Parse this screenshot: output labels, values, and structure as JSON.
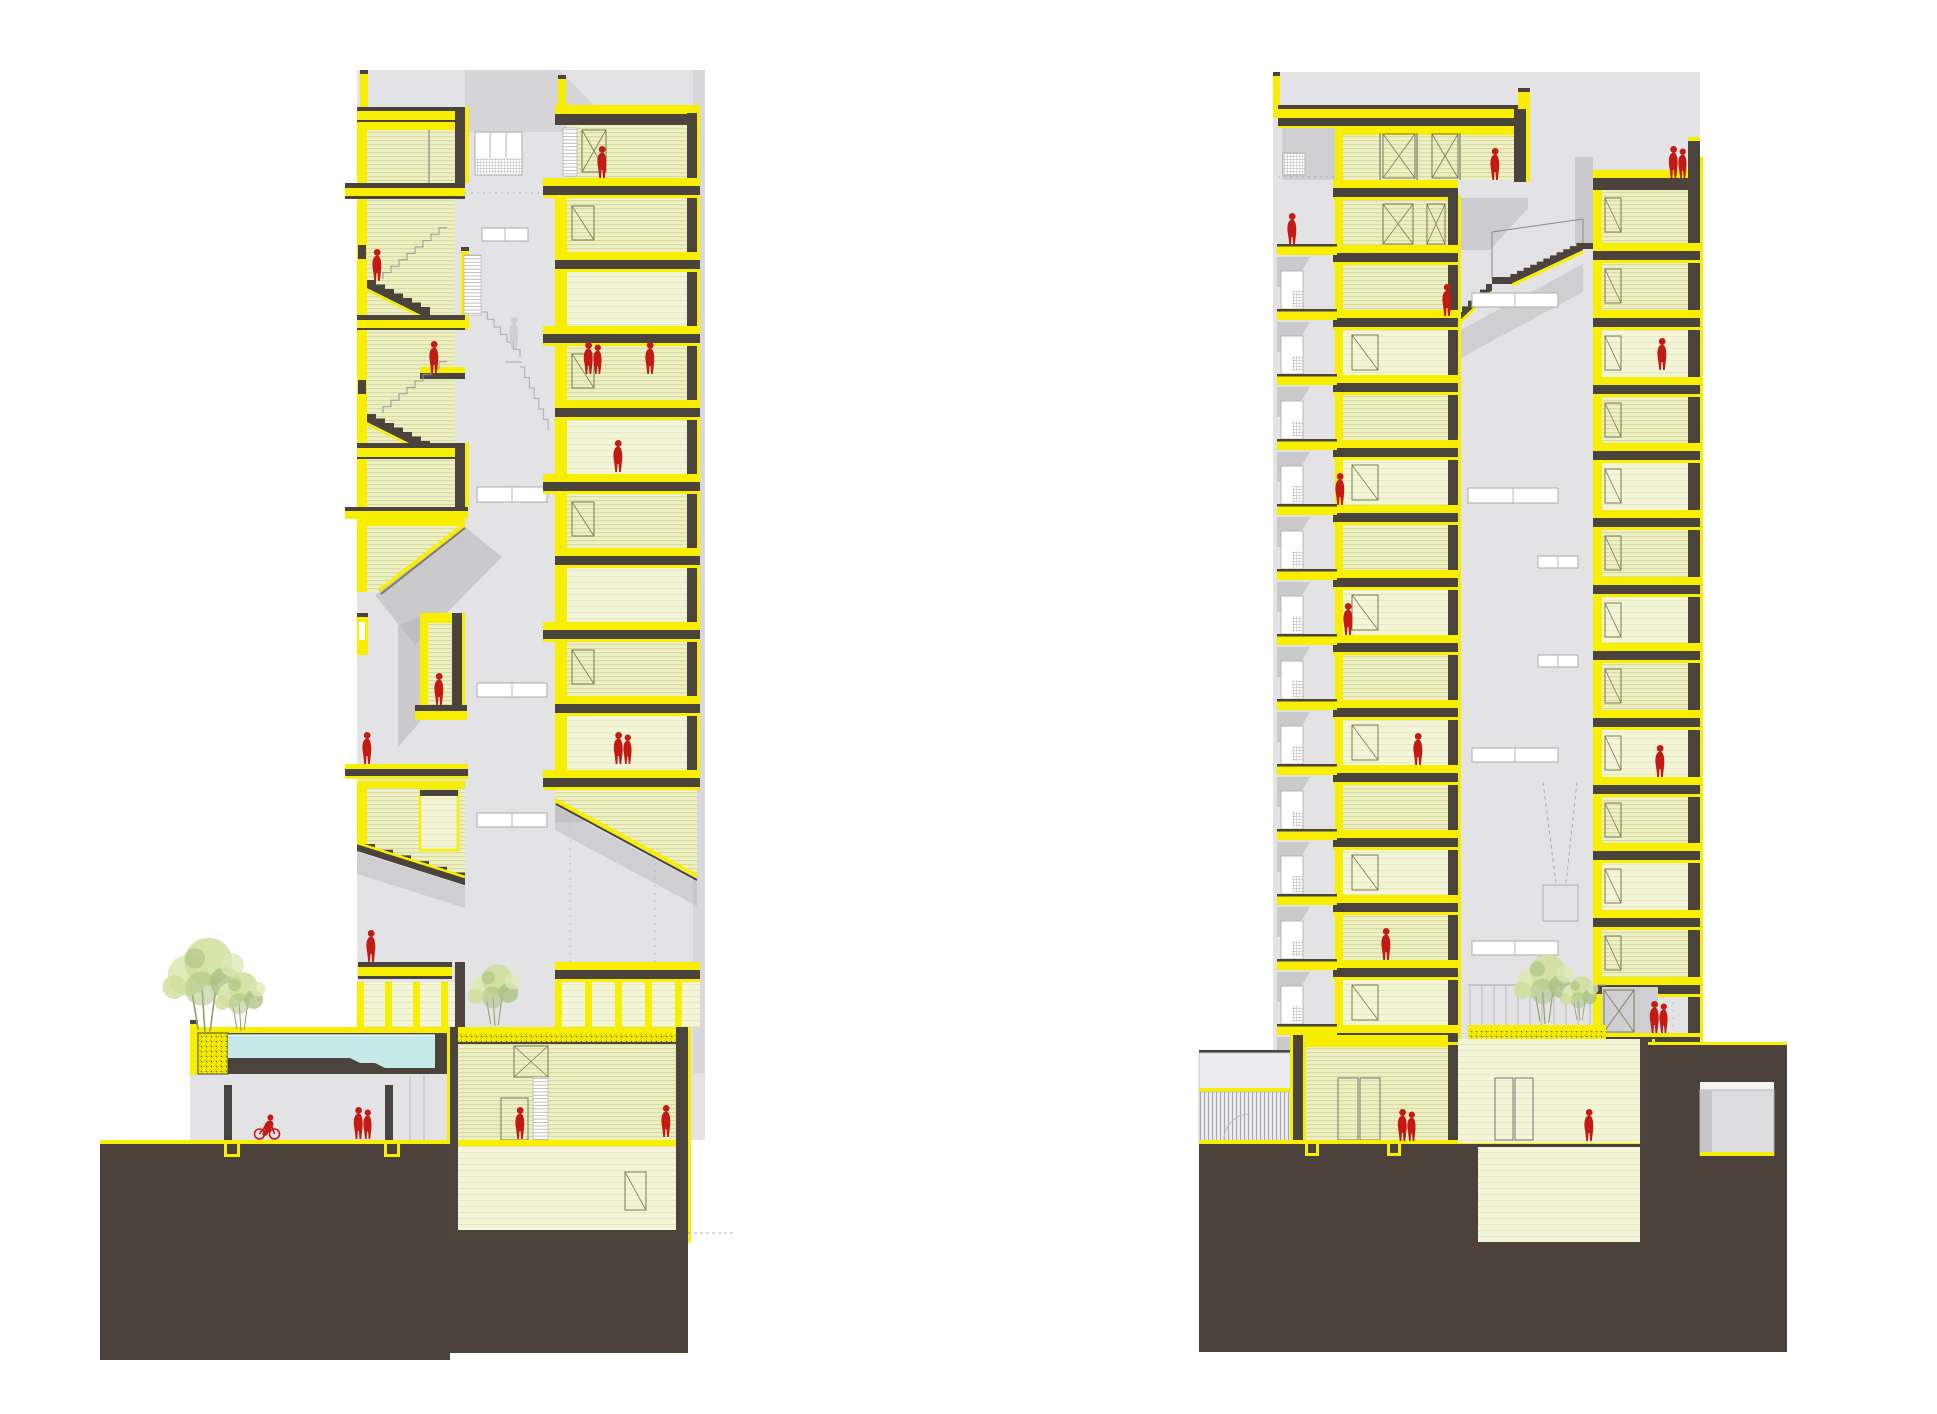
{
  "page": {
    "kind": "architectural-section-drawing",
    "sections": [
      {
        "id": "left-section",
        "label": "longitudinal section A"
      },
      {
        "id": "right-section",
        "label": "longitudinal section B"
      }
    ]
  },
  "colors": {
    "paper": "#ffffff",
    "backdrop": "#e3e3e5",
    "backdrop_dark": "#cfcfd1",
    "shadow": "#b2b2b4",
    "dark": "#4a443c",
    "ground": "#4a423b",
    "yellow": "#f7ee00",
    "room": "#edefc4",
    "roomline": "#d6d99a",
    "room_light": "#f3f5d8",
    "pool": "#c6eae9",
    "red": "#c31a13",
    "ghost": "#cfcfd1",
    "line": "#9a9a9c",
    "win": "#b7b7b9",
    "doorline": "#7a7a55",
    "green1": "#cfdf9a",
    "green2": "#a6c07f",
    "green3": "#dde9b4"
  },
  "left_section": {
    "right_stack": {
      "x": 555,
      "w": 145,
      "interior_x": 567,
      "interior_w": 120,
      "room_top": 125,
      "slabs": [
        178,
        252,
        326,
        400,
        474,
        548,
        622,
        696,
        770
      ]
    },
    "figures": [
      {
        "type": "person",
        "x": 377,
        "y": 281
      },
      {
        "type": "person",
        "x": 434,
        "y": 373
      },
      {
        "type": "person",
        "x": 602,
        "y": 178
      },
      {
        "type": "couple",
        "x": 593,
        "y": 374
      },
      {
        "type": "person",
        "x": 650,
        "y": 374
      },
      {
        "type": "person",
        "x": 618,
        "y": 472
      },
      {
        "type": "person",
        "x": 439,
        "y": 705
      },
      {
        "type": "person",
        "x": 367,
        "y": 764
      },
      {
        "type": "couple",
        "x": 623,
        "y": 764
      },
      {
        "type": "person",
        "x": 371,
        "y": 962
      },
      {
        "type": "bike",
        "x": 267,
        "y": 1139
      },
      {
        "type": "couple",
        "x": 363,
        "y": 1139
      },
      {
        "type": "person",
        "x": 520,
        "y": 1139
      },
      {
        "type": "person",
        "x": 666,
        "y": 1137
      },
      {
        "type": "ghost",
        "x": 514,
        "y": 349
      }
    ],
    "trees": [
      {
        "x": 205,
        "y": 1033,
        "s": 1.7
      },
      {
        "x": 241,
        "y": 1031,
        "s": 1.05
      },
      {
        "x": 495,
        "y": 1026,
        "s": 1.1
      }
    ]
  },
  "right_section": {
    "main_tower": {
      "x": 1333,
      "w": 125,
      "interior_x": 1343,
      "interior_w": 105,
      "room_top": 200,
      "slabs": [
        245,
        310,
        375,
        440,
        505,
        570,
        635,
        700,
        765,
        830,
        895,
        960,
        1025
      ]
    },
    "right_tower": {
      "x": 1593,
      "w": 107,
      "interior_x": 1602,
      "interior_w": 86,
      "room_top": 190,
      "slabs": [
        243,
        310,
        377,
        443,
        510,
        577,
        643,
        710,
        777,
        843,
        910,
        977
      ]
    },
    "figures": [
      {
        "type": "person",
        "x": 1292,
        "y": 245
      },
      {
        "type": "person",
        "x": 1495,
        "y": 180
      },
      {
        "type": "couple",
        "x": 1678,
        "y": 178
      },
      {
        "type": "person",
        "x": 1340,
        "y": 505
      },
      {
        "type": "person",
        "x": 1348,
        "y": 635
      },
      {
        "type": "person",
        "x": 1418,
        "y": 765
      },
      {
        "type": "person",
        "x": 1662,
        "y": 370
      },
      {
        "type": "person",
        "x": 1660,
        "y": 777
      },
      {
        "type": "person",
        "x": 1386,
        "y": 960
      },
      {
        "type": "couple",
        "x": 1659,
        "y": 1033
      },
      {
        "type": "couple",
        "x": 1407,
        "y": 1141
      },
      {
        "type": "person",
        "x": 1589,
        "y": 1141
      },
      {
        "type": "person",
        "x": 1447,
        "y": 316
      }
    ],
    "trees": [
      {
        "x": 1545,
        "y": 1024,
        "s": 1.25
      },
      {
        "x": 1580,
        "y": 1021,
        "s": 0.8
      }
    ]
  }
}
